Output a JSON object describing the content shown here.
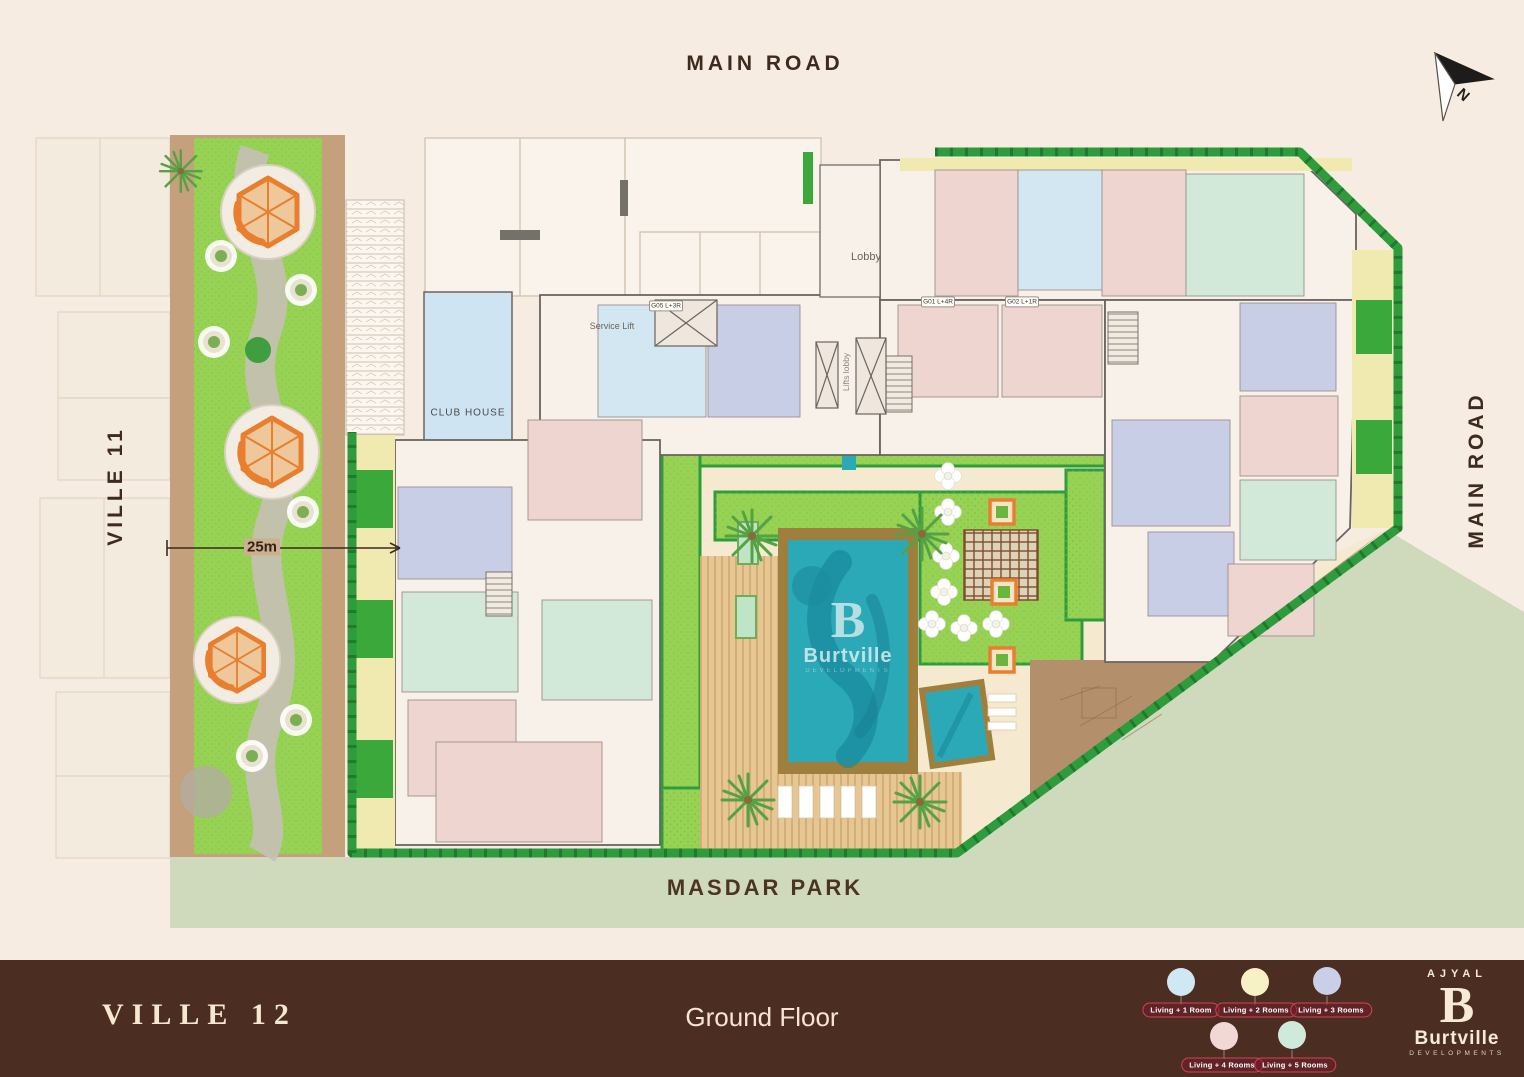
{
  "site": {
    "roads": {
      "top": "MAIN ROAD",
      "right": "MAIN ROAD"
    },
    "neighbors": {
      "left": "VILLE 11",
      "bottom": "MASDAR PARK"
    },
    "scale_label": "25m",
    "north_label": "N",
    "plan_labels": {
      "club_house": "CLUB HOUSE",
      "lobby": "Lobby",
      "service_lift": "Service Lift",
      "lifts_lobby": "Lifts lobby"
    },
    "unit_tags": [
      "G01 L+4R",
      "G02 L+1R",
      "G05 L+3R"
    ],
    "watermark": {
      "monogram": "B",
      "name": "Burtville",
      "sub": "DEVELOPMENTS"
    }
  },
  "footer": {
    "project": "VILLE 12",
    "floor": "Ground Floor",
    "legend": {
      "items": [
        {
          "label": "Living + 1 Room",
          "color": "#cfe9f4"
        },
        {
          "label": "Living + 2 Rooms",
          "color": "#f7f1c6"
        },
        {
          "label": "Living + 3 Rooms",
          "color": "#c9cfe8"
        },
        {
          "label": "Living + 4 Rooms",
          "color": "#f0d8d4"
        },
        {
          "label": "Living + 5 Rooms",
          "color": "#cfeadb"
        }
      ]
    },
    "brand": {
      "name": "AJYAL",
      "monogram": "B",
      "company": "Burtville",
      "tagline": "DEVELOPMENTS"
    }
  },
  "colors": {
    "background": "#f7ece1",
    "footer_bar": "#4b2e21",
    "hedge_green": "#2e9c3c",
    "lawn_green": "#97d254",
    "park_sage": "#cfdabc",
    "pool_teal": "#2ba9b6",
    "play_orange": "#e87f2f",
    "legend_pill_red": "#cf4458"
  }
}
